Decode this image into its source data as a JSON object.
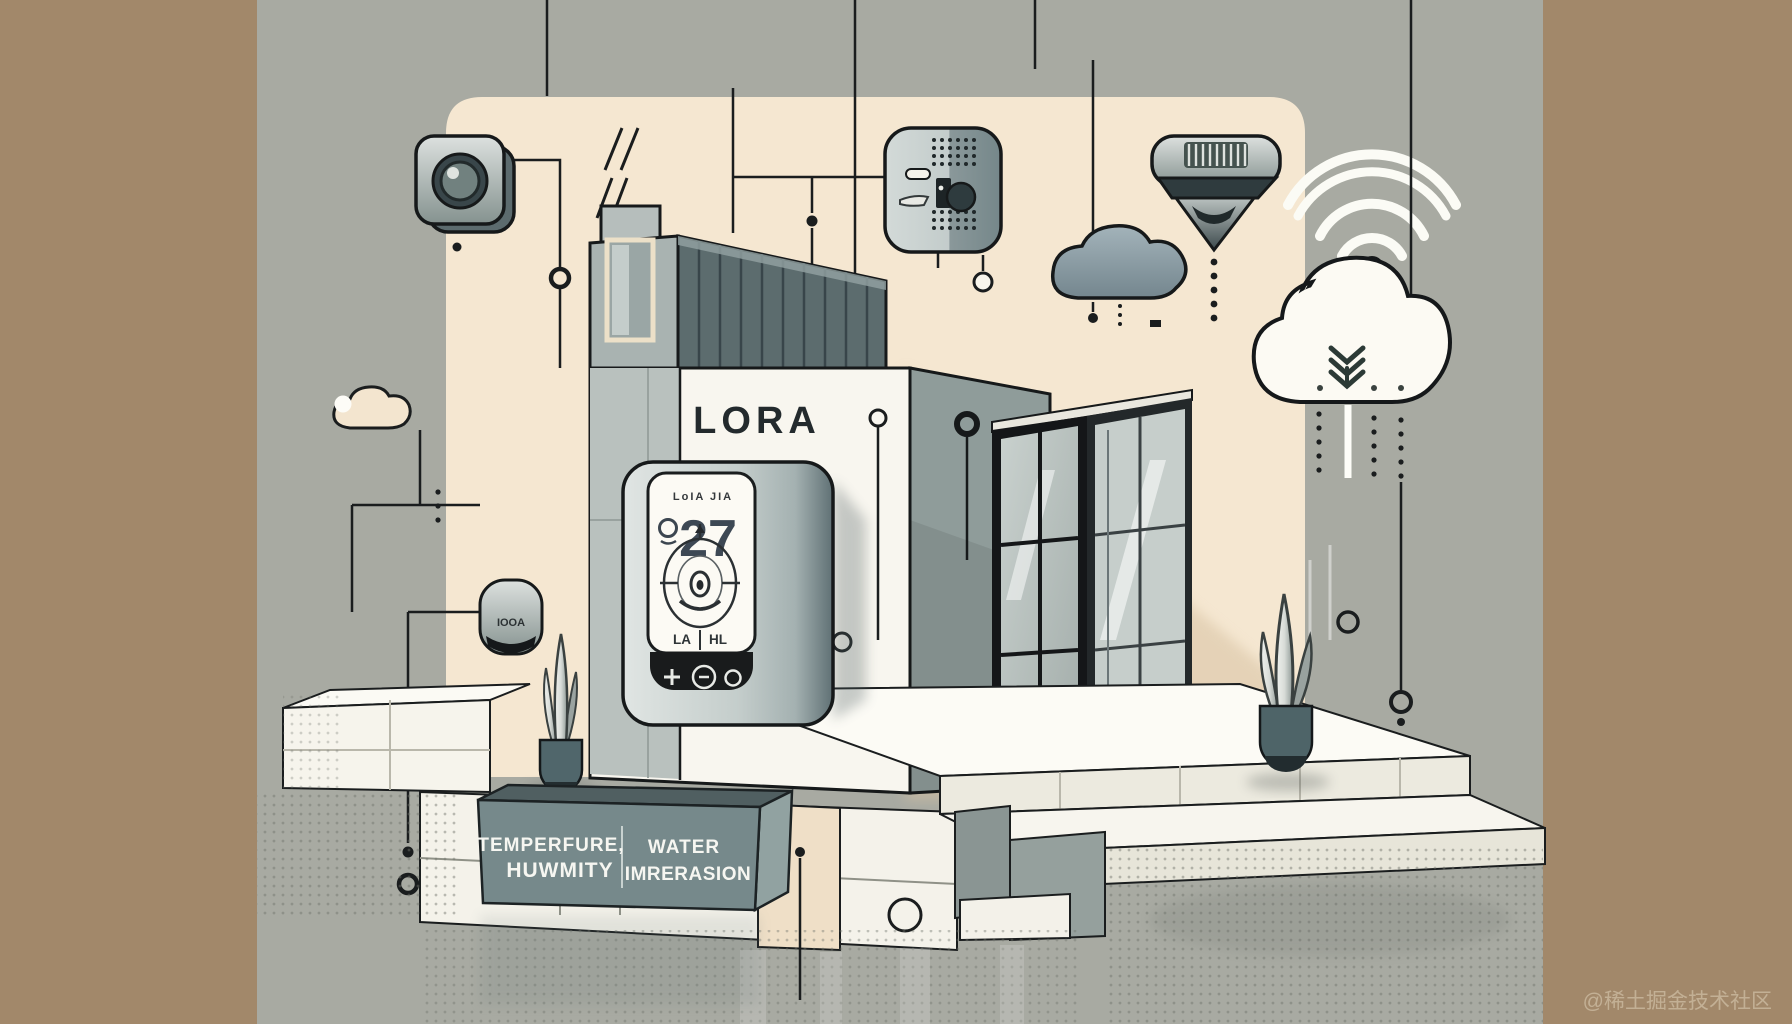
{
  "illustration": {
    "building_label": "LORA",
    "thermostat": {
      "brand_text": "LoIA JIA",
      "degree_symbol": "°",
      "temperature": "27",
      "low_label": "LA",
      "high_label": "HL",
      "plus_button": "+"
    },
    "sensor_sign": {
      "left_line1": "TEMPERFURE,",
      "left_line2": "HUWMITY",
      "right_line1": "WATER",
      "right_line2": "IMRERASION"
    },
    "wall_device_label": "IOOA",
    "watermark": "@稀土掘金技术社区",
    "icon_names": [
      "camera-sensor-icon",
      "speaker-device-icon",
      "ceiling-sensor-icon",
      "wifi-icon",
      "white-cloud-icon",
      "upload-chevrons-icon",
      "dark-cloud-icon",
      "small-cloud-icon",
      "wall-device-icon",
      "thermostat-dial-icon",
      "plant-icon",
      "network-node-icon"
    ],
    "colors": {
      "background": "#a8aaa2",
      "side_panels": "#a2886a",
      "wall_panel": "#f5e7d1",
      "building_white": "#f8f6ef",
      "roof_slats": "#5c6c6e",
      "sign": "#76898b",
      "thermostat_body": "#c9d1cf",
      "thermostat_screen": "#fcfaf4",
      "cloud_dark": "#8aa0a9",
      "cloud_white": "#fcfaf3",
      "line_dark": "#1a1d1e"
    }
  }
}
